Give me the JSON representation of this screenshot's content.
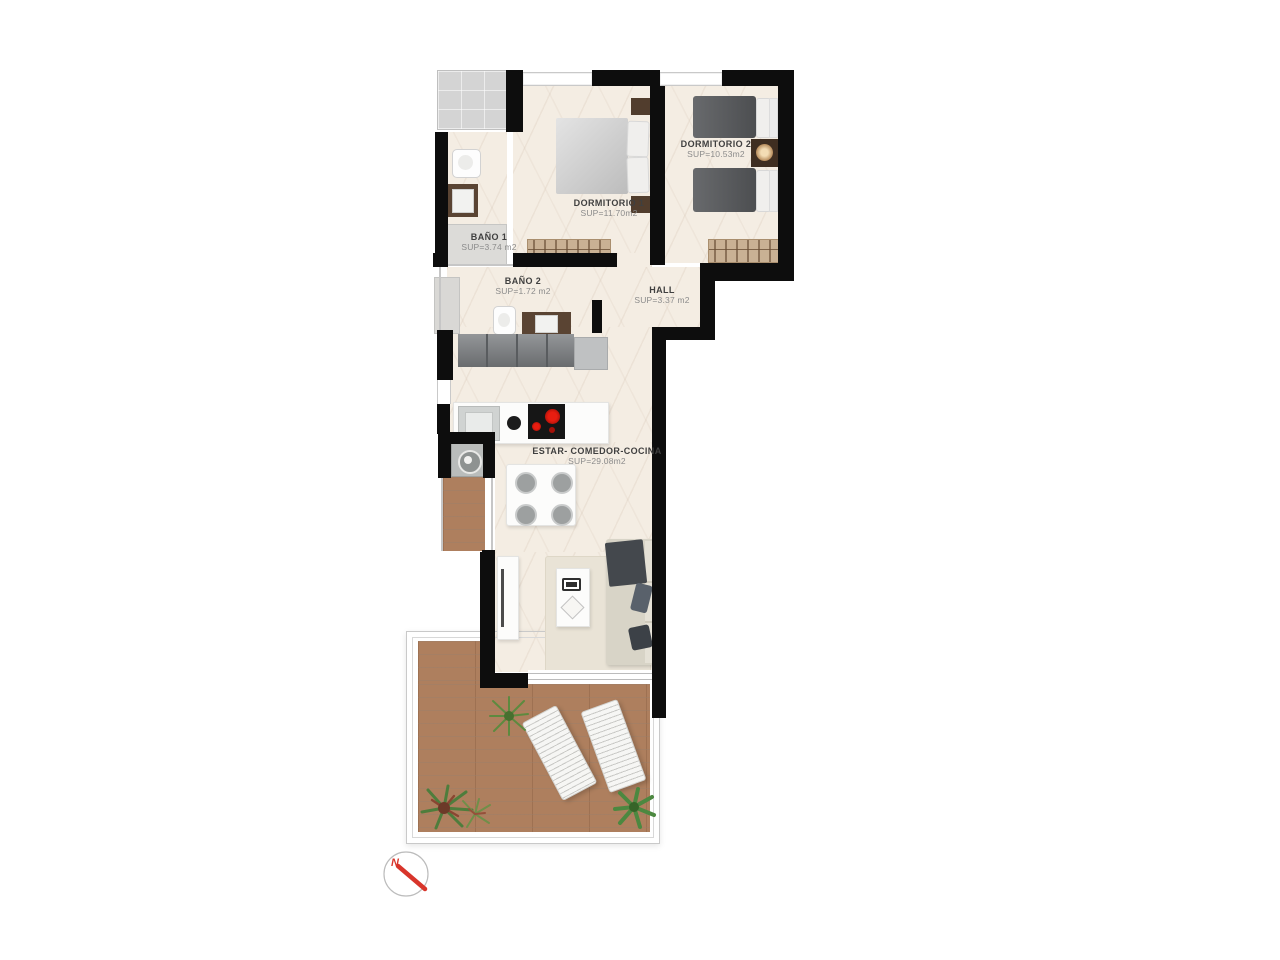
{
  "plan": {
    "rooms": [
      {
        "key": "dormitorio-1",
        "name": "DORMITORIO 1",
        "area": "SUP=11.70m2"
      },
      {
        "key": "dormitorio-2",
        "name": "DORMITORIO 2",
        "area": "SUP=10.53m2"
      },
      {
        "key": "bano-1",
        "name": "BAÑO 1",
        "area": "SUP=3.74 m2"
      },
      {
        "key": "bano-2",
        "name": "BAÑO 2",
        "area": "SUP=1.72 m2"
      },
      {
        "key": "hall",
        "name": "HALL",
        "area": "SUP=3.37 m2"
      },
      {
        "key": "estar-comedor-cocina",
        "name": "ESTAR- COMEDOR-COCINA",
        "area": "SUP=29.08m2"
      }
    ],
    "compass": {
      "north_label": "N"
    },
    "colors": {
      "wall": "#0d0d0d",
      "marble_floor": "#f4ede3",
      "terrace_wood": "#ae7f5e",
      "accent_red": "#d8352b",
      "cooktop_burner": "#cc1414"
    }
  }
}
